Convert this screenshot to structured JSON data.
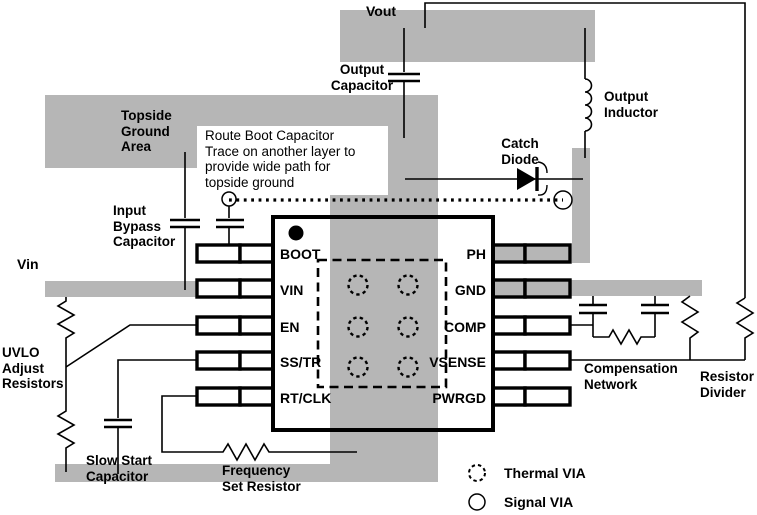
{
  "figure": {
    "type": "pcb-layout-example-diagram",
    "background": "#ffffff",
    "copper_pour_color": "#b6b6b6",
    "line_color": "#000000"
  },
  "labels": {
    "vout": "Vout",
    "vin": "Vin",
    "output_capacitor": "Output\nCapacitor",
    "output_inductor": "Output\nInductor",
    "topside_ground_area": "Topside\nGround\nArea",
    "route_note": "Route Boot Capacitor\nTrace on another layer to\nprovide wide path for\ntopside ground",
    "catch_diode": "Catch\nDiode",
    "input_bypass_capacitor": "Input\nBypass\nCapacitor",
    "uvlo_adjust_resistors": "UVLO\nAdjust\nResistors",
    "slow_start_capacitor": "Slow Start\nCapacitor",
    "frequency_set_resistor": "Frequency\nSet Resistor",
    "compensation_network": "Compensation\nNetwork",
    "resistor_divider": "Resistor\nDivider"
  },
  "ic": {
    "left_pins": [
      "BOOT",
      "VIN",
      "EN",
      "SS/TR",
      "RT/CLK"
    ],
    "right_pins": [
      "PH",
      "GND",
      "COMP",
      "VSENSE",
      "PWRGD"
    ]
  },
  "legend": {
    "thermal_via": "Thermal VIA",
    "signal_via": "Signal VIA"
  }
}
